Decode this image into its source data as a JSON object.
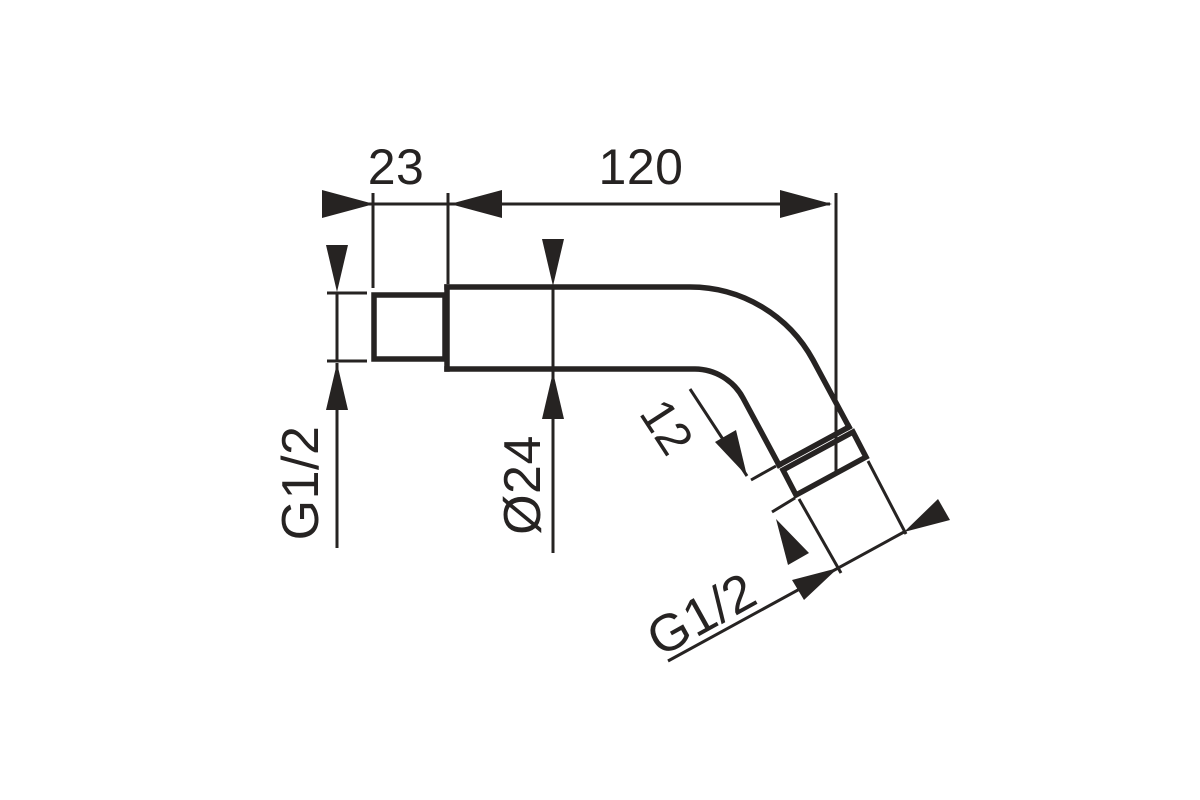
{
  "figure": {
    "type": "technical-dimension-drawing",
    "subject": "angled shower arm pipe, side view",
    "background_color": "#ffffff",
    "line_color": "#262322",
    "dimensions": [
      {
        "id": "inlet-length",
        "label": "23",
        "orientation": "horizontal"
      },
      {
        "id": "arm-length",
        "label": "120",
        "orientation": "horizontal"
      },
      {
        "id": "inlet-thread",
        "label": "G1/2",
        "orientation": "vertical"
      },
      {
        "id": "pipe-diameter",
        "label": "Ø24",
        "orientation": "vertical"
      },
      {
        "id": "thread-length",
        "label": "12",
        "orientation": "diagonal"
      },
      {
        "id": "outlet-thread",
        "label": "G1/2",
        "orientation": "diagonal"
      }
    ]
  }
}
